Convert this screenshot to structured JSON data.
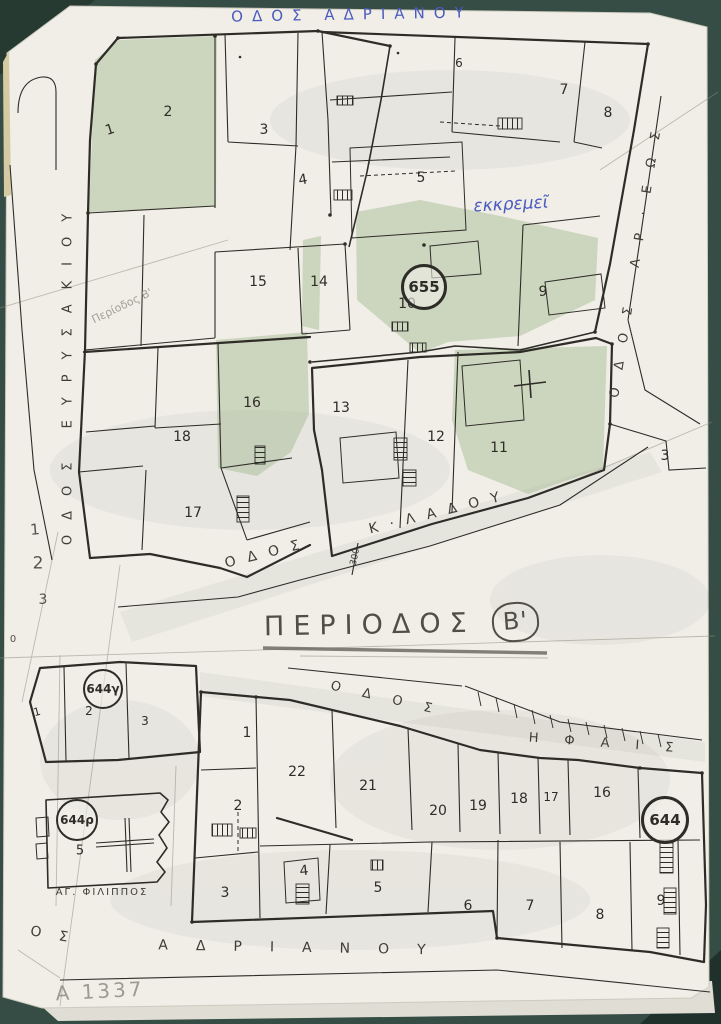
{
  "palette": {
    "background": "#354d44",
    "paper": "#f0eee7",
    "ink": "#2e2c27",
    "green_shading": "#a7bc96",
    "blue_ink": "#4a5abe",
    "pencil": "#8f8c82"
  },
  "title": {
    "text": "ΠΕΡΙΟΔΟΣ",
    "badge": "Β'"
  },
  "upper_map": {
    "street_labels": [
      {
        "id": "adrianou-top",
        "text": "ΟΔΟΣ ΑΔΡΙΑΝΟΥ",
        "x": 352,
        "y": 15,
        "rot": -1,
        "size": 15,
        "spacing": 9,
        "color": "blue"
      },
      {
        "id": "evrysakiou",
        "text": "ΟΔΟΣ ΕΥΡΥΣΑΚΙΟΥ",
        "x": 68,
        "y": 372,
        "rot": -90,
        "size": 13,
        "spacing": 15,
        "color": "ink"
      },
      {
        "id": "areos",
        "text": "ΟΔΟΣ ΑΡ·ΕΩΣ",
        "x": 637,
        "y": 256,
        "rot": -81,
        "size": 13,
        "spacing": 18,
        "color": "ink"
      },
      {
        "id": "odos-kladou",
        "text": "ΟΔΟΣ",
        "x": 268,
        "y": 553,
        "rot": -14,
        "size": 14,
        "spacing": 12,
        "color": "ink"
      },
      {
        "id": "kladou",
        "text": "Κ·ΛΑΔΟΥ",
        "x": 440,
        "y": 512,
        "rot": -14,
        "size": 14,
        "spacing": 12,
        "color": "ink"
      }
    ],
    "block_number": {
      "text": "655",
      "x": 424,
      "y": 287,
      "r": 20,
      "bold": true,
      "size": 15
    },
    "parcels": [
      {
        "text": "1",
        "x": 110,
        "y": 130,
        "rot": -18
      },
      {
        "text": "2",
        "x": 168,
        "y": 112
      },
      {
        "text": "3",
        "x": 264,
        "y": 130
      },
      {
        "text": "4",
        "x": 303,
        "y": 180,
        "rot": -10
      },
      {
        "text": "5",
        "x": 421,
        "y": 178
      },
      {
        "text": "6",
        "x": 459,
        "y": 63,
        "size": 12
      },
      {
        "text": "7",
        "x": 564,
        "y": 90
      },
      {
        "text": "8",
        "x": 608,
        "y": 113
      },
      {
        "text": "9",
        "x": 543,
        "y": 292
      },
      {
        "text": "10",
        "x": 407,
        "y": 304
      },
      {
        "text": "13",
        "x": 341,
        "y": 408
      },
      {
        "text": "12",
        "x": 436,
        "y": 437
      },
      {
        "text": "11",
        "x": 499,
        "y": 448
      },
      {
        "text": "14",
        "x": 319,
        "y": 282
      },
      {
        "text": "15",
        "x": 258,
        "y": 282
      },
      {
        "text": "16",
        "x": 252,
        "y": 403
      },
      {
        "text": "17",
        "x": 193,
        "y": 513
      },
      {
        "text": "18",
        "x": 182,
        "y": 437
      },
      {
        "text": "3",
        "x": 665,
        "y": 456
      }
    ],
    "blue_note": {
      "text": "εκκρεμεῖ",
      "x": 511,
      "y": 205,
      "rot": -3,
      "size": 17
    },
    "pencil_note": {
      "text": "Περίοδος Β'",
      "x": 122,
      "y": 306,
      "rot": -26,
      "size": 11
    },
    "survey_mark": {
      "text": "300",
      "x": 356,
      "y": 557,
      "rot": -78,
      "size": 9
    }
  },
  "lower_map": {
    "street_labels": [
      {
        "id": "odos-ifaistou",
        "text": "ΟΔΟΣ",
        "x": 392,
        "y": 700,
        "rot": 13,
        "size": 13,
        "spacing": 22,
        "color": "ink"
      },
      {
        "id": "ifaistou",
        "text": "ΗΦΑΙΣ",
        "x": 614,
        "y": 744,
        "rot": 4,
        "size": 13,
        "spacing": 26,
        "color": "ink"
      },
      {
        "id": "adrianou-bottom-os",
        "text": "ΟΣ",
        "x": 58,
        "y": 936,
        "rot": 10,
        "size": 14,
        "spacing": 18,
        "color": "ink"
      },
      {
        "id": "adrianou-bottom",
        "text": "ΑΔΡΙΑΝΟΥ",
        "x": 306,
        "y": 948,
        "rot": 1,
        "size": 14,
        "spacing": 28,
        "color": "ink"
      }
    ],
    "block_numbers": [
      {
        "text": "644γ",
        "x": 103,
        "y": 689,
        "r": 18,
        "size": 12
      },
      {
        "text": "644ρ",
        "x": 77,
        "y": 820,
        "r": 19,
        "size": 12
      },
      {
        "text": "644",
        "x": 665,
        "y": 820,
        "r": 21,
        "bold": true,
        "size": 15
      }
    ],
    "parcels": [
      {
        "text": "1",
        "x": 247,
        "y": 733
      },
      {
        "text": "2",
        "x": 238,
        "y": 806
      },
      {
        "text": "3",
        "x": 225,
        "y": 893
      },
      {
        "text": "4",
        "x": 304,
        "y": 871,
        "rot": -6
      },
      {
        "text": "5",
        "x": 378,
        "y": 888
      },
      {
        "text": "6",
        "x": 468,
        "y": 906
      },
      {
        "text": "7",
        "x": 530,
        "y": 906
      },
      {
        "text": "8",
        "x": 600,
        "y": 915
      },
      {
        "text": "9",
        "x": 661,
        "y": 901
      },
      {
        "text": "22",
        "x": 297,
        "y": 772
      },
      {
        "text": "21",
        "x": 368,
        "y": 786
      },
      {
        "text": "20",
        "x": 438,
        "y": 811
      },
      {
        "text": "19",
        "x": 478,
        "y": 806
      },
      {
        "text": "18",
        "x": 519,
        "y": 799
      },
      {
        "text": "17",
        "x": 551,
        "y": 797,
        "size": 12
      },
      {
        "text": "16",
        "x": 602,
        "y": 793
      },
      {
        "text": "1",
        "x": 37,
        "y": 712,
        "size": 11,
        "rot": -15
      },
      {
        "text": "2",
        "x": 89,
        "y": 711,
        "size": 12
      },
      {
        "text": "3",
        "x": 145,
        "y": 721,
        "size": 12
      },
      {
        "text": "5",
        "x": 80,
        "y": 851,
        "size": 13
      }
    ],
    "church_label": {
      "text": "ΑΓ. ΦΙΛΙΠΠΟΣ",
      "x": 102,
      "y": 893,
      "size": 10,
      "spacing": 2
    }
  },
  "margin": {
    "numbers": [
      {
        "text": "1",
        "x": 35,
        "y": 530,
        "size": 15,
        "rot": -5
      },
      {
        "text": "2",
        "x": 38,
        "y": 564,
        "size": 17
      },
      {
        "text": "3",
        "x": 43,
        "y": 600,
        "size": 14
      },
      {
        "text": "0",
        "x": 13,
        "y": 640,
        "size": 10
      }
    ],
    "archive_code": {
      "text": "Α 1337",
      "x": 100,
      "y": 991,
      "rot": -3,
      "size": 20,
      "spacing": 3
    }
  }
}
